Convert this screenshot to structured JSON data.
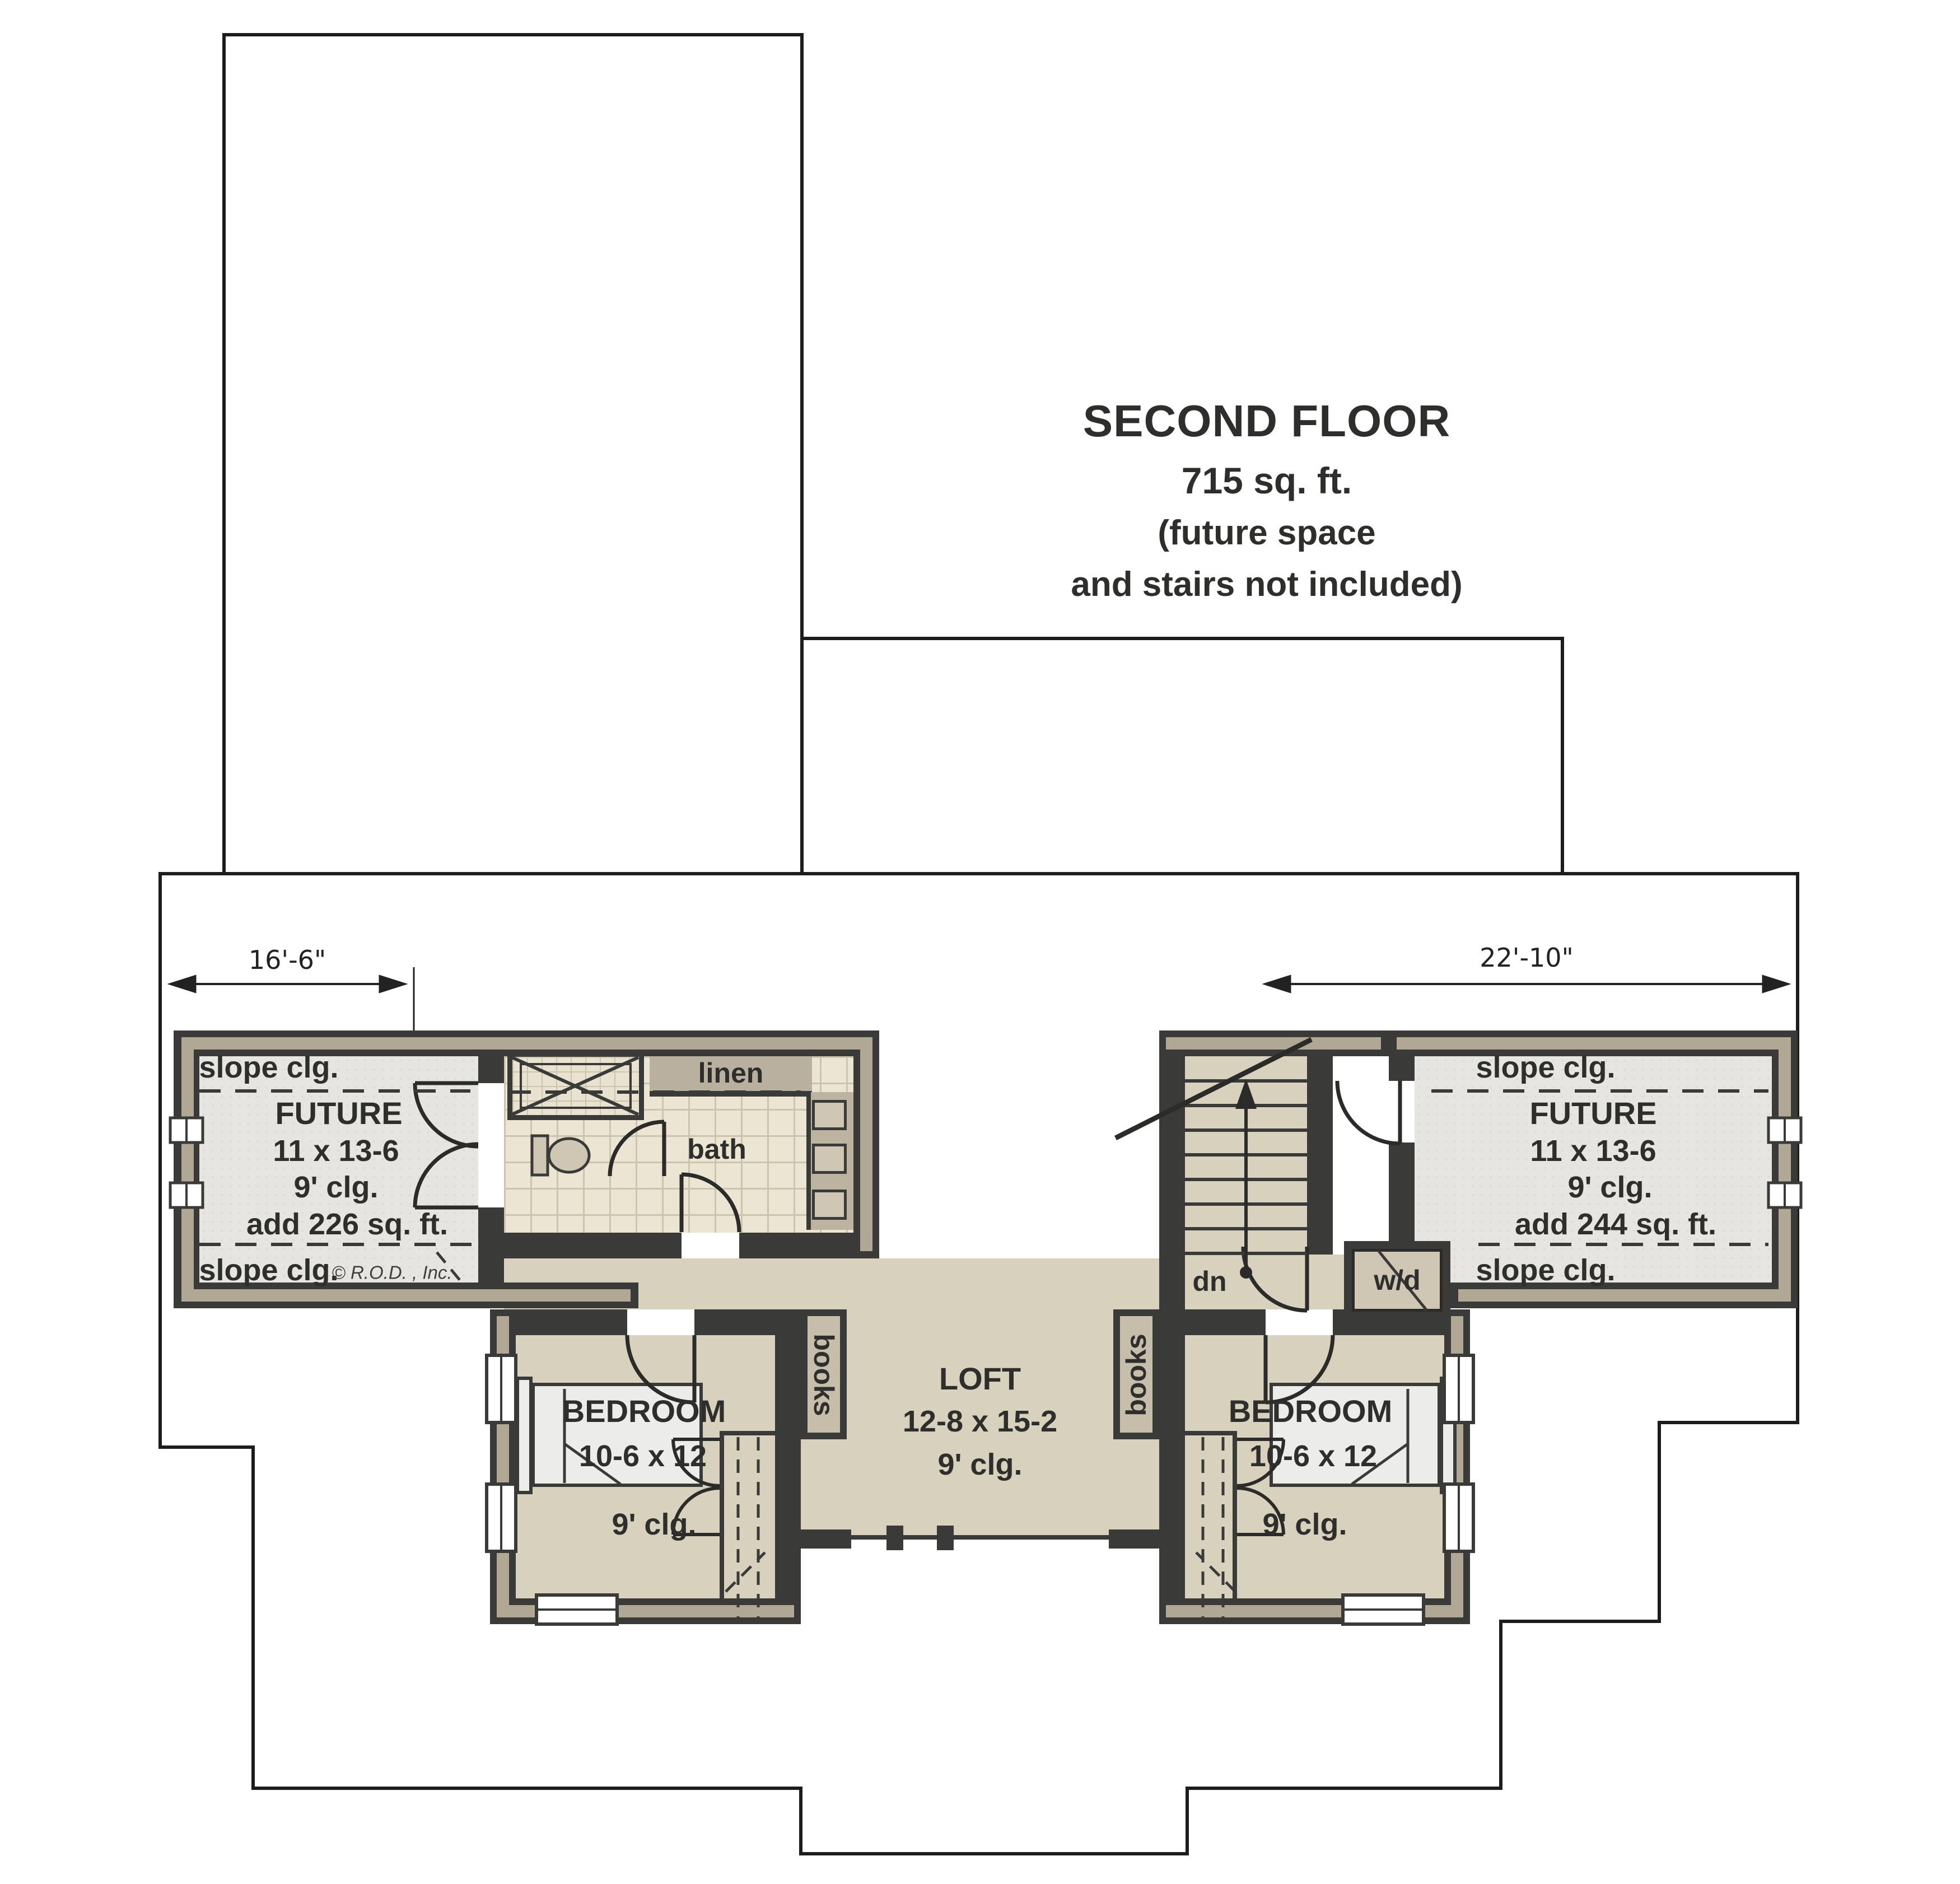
{
  "title": {
    "line1": "SECOND FLOOR",
    "line2": "715 sq. ft.",
    "line3": "(future space",
    "line4": "and stairs not included)"
  },
  "dimensions": {
    "left_width": "16'-6\"",
    "right_width": "22'-10\""
  },
  "labels": {
    "future_left": {
      "slope_top": "slope clg.",
      "name": "FUTURE",
      "size": "11 x 13-6",
      "ceiling": "9' clg.",
      "area": "add 226 sq. ft.",
      "slope_bottom": "slope clg."
    },
    "future_right": {
      "slope_top": "slope clg.",
      "name": "FUTURE",
      "size": "11 x 13-6",
      "ceiling": "9' clg.",
      "area": "add 244 sq. ft.",
      "slope_bottom": "slope clg."
    },
    "bath": {
      "name": "bath",
      "linen": "linen"
    },
    "loft": {
      "name": "LOFT",
      "size": "12-8 x 15-2",
      "ceiling": "9' clg."
    },
    "bedroom_left": {
      "name": "BEDROOM",
      "size": "10-6 x 12",
      "ceiling": "9' clg."
    },
    "bedroom_right": {
      "name": "BEDROOM",
      "size": "10-6 x 12",
      "ceiling": "9' clg."
    },
    "stair": {
      "direction": "dn"
    },
    "laundry": {
      "unit": "w/d"
    },
    "bookshelf_left": "books",
    "bookshelf_right": "books",
    "copyright": "© R.O.D. , Inc."
  },
  "colors": {
    "wall": "#3a3a38",
    "wall_poche": "#b1a795",
    "floor_tan": "#d8d1bd",
    "floor_future": "#e6e5e2",
    "bath_tile": "#ece5d4",
    "outline": "#1c1c1c"
  }
}
